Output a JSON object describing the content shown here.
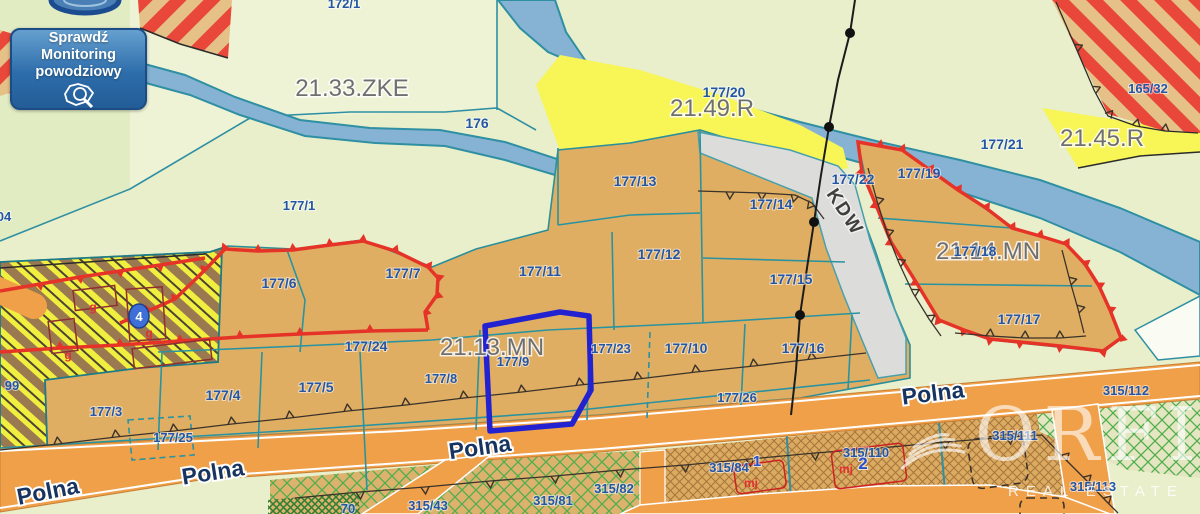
{
  "flood_button": {
    "line1": "Sprawdź",
    "line2": "Monitoring",
    "line3": "powodziowy"
  },
  "watermark": {
    "brand": "ORFIN",
    "tagline": "REAL ESTATE"
  },
  "zones": {
    "z2133": "21.33.ZKE",
    "z2149": "21.49.R",
    "z2145": "21.45.R",
    "z2113": "21.13.MN",
    "z2114": "21.14.MN"
  },
  "streets": {
    "polna": "Polna",
    "kdw": "KDW"
  },
  "parcels": {
    "p172_1": "172/1",
    "p176": "176",
    "p177_1": "177/1",
    "p177_20": "177/20",
    "p177_21": "177/21",
    "p165_32": "165/32",
    "p177_13": "177/13",
    "p177_14": "177/14",
    "p177_22": "177/22",
    "p177_19": "177/19",
    "p177_6": "177/6",
    "p177_7": "177/7",
    "p177_11": "177/11",
    "p177_12": "177/12",
    "p177_15": "177/15",
    "p177_18": "177/18",
    "p177_17": "177/17",
    "p177_24": "177/24",
    "p177_8": "177/8",
    "p177_9": "177/9",
    "p177_23": "177/23",
    "p177_10": "177/10",
    "p177_16": "177/16",
    "p177_26": "177/26",
    "p177_3": "177/3",
    "p177_4": "177/4",
    "p177_5": "177/5",
    "p177_25": "177/25",
    "p315_112": "315/112",
    "p315_111": "315/111",
    "p315_113": "315/113",
    "p315_110": "315/110",
    "p315_84": "315/84",
    "p315_81": "315/81",
    "p315_82": "315/82",
    "p315_43": "315/43",
    "p70": "70",
    "p99": "99",
    "p04": "04"
  },
  "markers": {
    "gas": "g",
    "badge4": "4",
    "badge1": "1",
    "badge2": "2",
    "mj": "mj"
  },
  "highlight": {
    "parcel": "177/9",
    "color": "#2222d0"
  },
  "palette": {
    "water": "#86b3d3",
    "zone_yellow": "#f8f556",
    "parcel_tan": "#dfae63",
    "boundary_red": "#e63328",
    "road_orange": "#efa049",
    "label_blue": "#2456a4",
    "zone_gray": "#6f6f6f",
    "button_blue": "#2d6dab",
    "hatch_red": "#e8473a",
    "corridor_yellow": "#f0ee3e"
  }
}
